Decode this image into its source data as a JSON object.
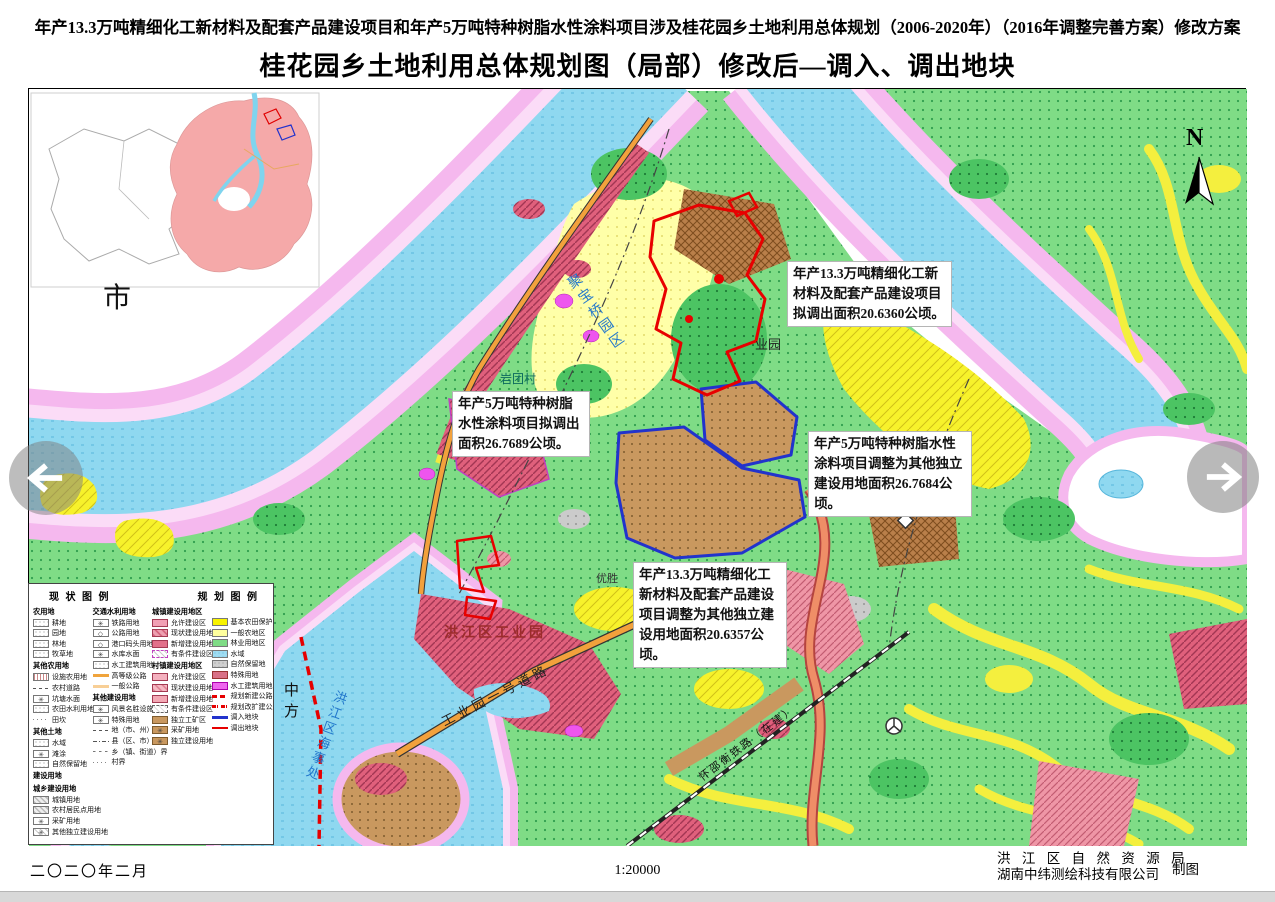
{
  "header": {
    "doc_title": "年产13.3万吨精细化工新材料及配套产品建设项目和年产5万吨特种树脂水性涂料项目涉及桂花园乡土地利用总体规划（2006-2020年）（2016年调整完善方案）修改方案",
    "map_title": "桂花园乡土地利用总体规划图（局部）修改后—调入、调出地块"
  },
  "map": {
    "north_label": "N",
    "inset": {
      "label": "市"
    },
    "labels": [
      {
        "text": "聚宝桥园区"
      },
      {
        "text": "岩团村"
      },
      {
        "text": "业园"
      },
      {
        "text": "优胜"
      },
      {
        "text": "洪江区工业园"
      },
      {
        "text": "工业园一号道路"
      },
      {
        "text": "中方"
      },
      {
        "text": "金洲"
      },
      {
        "text": "怀邵衡铁路（在建）"
      },
      {
        "text": "洪江区海事处"
      }
    ],
    "annotations": [
      {
        "text": "年产13.3万吨精细化工新材料及配套产品建设项目拟调出面积20.6360公顷。"
      },
      {
        "text": "年产5万吨特种树脂水性涂料项目拟调出面积26.7689公顷。"
      },
      {
        "text": "年产5万吨特种树脂水性涂料项目调整为其他独立建设用地面积26.7684公顷。"
      },
      {
        "text": "年产13.3万吨精细化工新材料及配套产品建设项目调整为其他独立建设用地面积20.6357公顷。"
      }
    ]
  },
  "legend": {
    "status_title": "现 状 图 例",
    "plan_title": "规 划 图 例",
    "col1": [
      {
        "t": "h",
        "label": "农用地"
      },
      {
        "t": "i",
        "label": "耕地",
        "sw": "dot"
      },
      {
        "t": "i",
        "label": "园地",
        "sw": "dot"
      },
      {
        "t": "i",
        "label": "林地",
        "sw": "dot"
      },
      {
        "t": "i",
        "label": "牧草地",
        "sw": "dot"
      },
      {
        "t": "h",
        "label": "其他农用地"
      },
      {
        "t": "i",
        "label": "设施农用地",
        "sw": "grid"
      },
      {
        "t": "i",
        "label": "农村道路",
        "sw": "bdash"
      },
      {
        "t": "i",
        "label": "坑塘水面",
        "sw": "symw"
      },
      {
        "t": "i",
        "label": "农田水利用地",
        "sw": "dot"
      },
      {
        "t": "i",
        "label": "田坎",
        "sw": "bdot"
      },
      {
        "t": "h",
        "label": "其他土地"
      },
      {
        "t": "i",
        "label": "水域",
        "sw": "dot"
      },
      {
        "t": "i",
        "label": "滩涂",
        "sw": "symw"
      },
      {
        "t": "i",
        "label": "自然保留地",
        "sw": "dot"
      },
      {
        "t": "h",
        "label": "建设用地"
      },
      {
        "t": "h",
        "label": "城乡建设用地"
      },
      {
        "t": "i",
        "label": "城镇用地",
        "sw": "hatchg"
      },
      {
        "t": "i",
        "label": "农村居民点用地",
        "sw": "hatchg"
      },
      {
        "t": "i",
        "label": "采矿用地",
        "sw": "symw"
      },
      {
        "t": "i",
        "label": "其他独立建设用地",
        "sw": "hatchsym"
      }
    ],
    "col2": [
      {
        "t": "h",
        "label": "交通水利用地"
      },
      {
        "t": "i",
        "label": "铁路用地",
        "sw": "symw"
      },
      {
        "t": "i",
        "label": "公路用地",
        "sw": "symd"
      },
      {
        "t": "i",
        "label": "港口码头用地",
        "sw": "symd"
      },
      {
        "t": "i",
        "label": "水库水面",
        "sw": "symw"
      },
      {
        "t": "i",
        "label": "水工建筑用地",
        "sw": "dot"
      },
      {
        "t": "i",
        "label": "高等级公路",
        "sw": "lineo"
      },
      {
        "t": "i",
        "label": "一般公路",
        "sw": "linelo"
      },
      {
        "t": "h",
        "label": "其他建设用地"
      },
      {
        "t": "i",
        "label": "风景名胜设施用地",
        "sw": "symw"
      },
      {
        "t": "i",
        "label": "特殊用地",
        "sw": "symw"
      },
      {
        "t": "i",
        "label": "地（市、州）界",
        "sw": "bdash"
      },
      {
        "t": "i",
        "label": "县（区、市）界",
        "sw": "bdashdot"
      },
      {
        "t": "i",
        "label": "乡（镇、街道）界",
        "sw": "bdash2"
      },
      {
        "t": "i",
        "label": "村界",
        "sw": "bdot"
      }
    ],
    "col3": [
      {
        "t": "h",
        "label": "城镇建设用地区"
      },
      {
        "t": "i",
        "label": "允许建设区",
        "sw": "pinkc"
      },
      {
        "t": "i",
        "label": "现状建设用地",
        "sw": "rosehatch"
      },
      {
        "t": "i",
        "label": "新增建设用地",
        "sw": "rose"
      },
      {
        "t": "i",
        "label": "有条件建设区",
        "sw": "cond"
      },
      {
        "t": "h",
        "label": "村镇建设用地区"
      },
      {
        "t": "i",
        "label": "允许建设区",
        "sw": "pinkc2"
      },
      {
        "t": "i",
        "label": "现状建设用地",
        "sw": "rosehatch2"
      },
      {
        "t": "i",
        "label": "新增建设用地",
        "sw": "roselight"
      },
      {
        "t": "i",
        "label": "有条件建设区",
        "sw": "cond2"
      },
      {
        "t": "i",
        "label": "独立工矿区",
        "sw": "tan"
      },
      {
        "t": "i",
        "label": "采矿用地",
        "sw": "tansym"
      },
      {
        "t": "i",
        "label": "独立建设用地",
        "sw": "tansym"
      }
    ],
    "col4": [
      {
        "t": "i",
        "label": "基本农田保护区",
        "sw": "yellow"
      },
      {
        "t": "i",
        "label": "一般农地区",
        "sw": "paleyellow"
      },
      {
        "t": "i",
        "label": "林业用地区",
        "sw": "green"
      },
      {
        "t": "i",
        "label": "水域",
        "sw": "cyan"
      },
      {
        "t": "i",
        "label": "自然保留地",
        "sw": "gray"
      },
      {
        "t": "i",
        "label": "特殊用地",
        "sw": "rosedark"
      },
      {
        "t": "i",
        "label": "水工建筑用地",
        "sw": "magenta"
      },
      {
        "t": "i",
        "label": "规划新建公路",
        "sw": "reddash"
      },
      {
        "t": "i",
        "label": "规划改扩建公路",
        "sw": "reddashdot"
      },
      {
        "t": "i",
        "label": "调入地块",
        "sw": "blueline"
      },
      {
        "t": "i",
        "label": "调出地块",
        "sw": "redline"
      }
    ]
  },
  "footer": {
    "date": "二〇二〇年二月",
    "scale": "1:20000",
    "agency_line1": "洪 江 区 自 然 资 源 局",
    "agency_line2": "湖南中纬测绘科技有限公司",
    "credit": "制图"
  },
  "colors": {
    "water": "#8fd8f0",
    "forest": "#7fdc86",
    "basic_farmland": "#f8f300",
    "general_farmland": "#ffff9e",
    "built_up": "#e0607c",
    "independent_industry": "#c9985f",
    "river_buffer": "#f5b8ee",
    "block_in_outline": "#2233cc",
    "block_out_outline": "#e60000"
  }
}
